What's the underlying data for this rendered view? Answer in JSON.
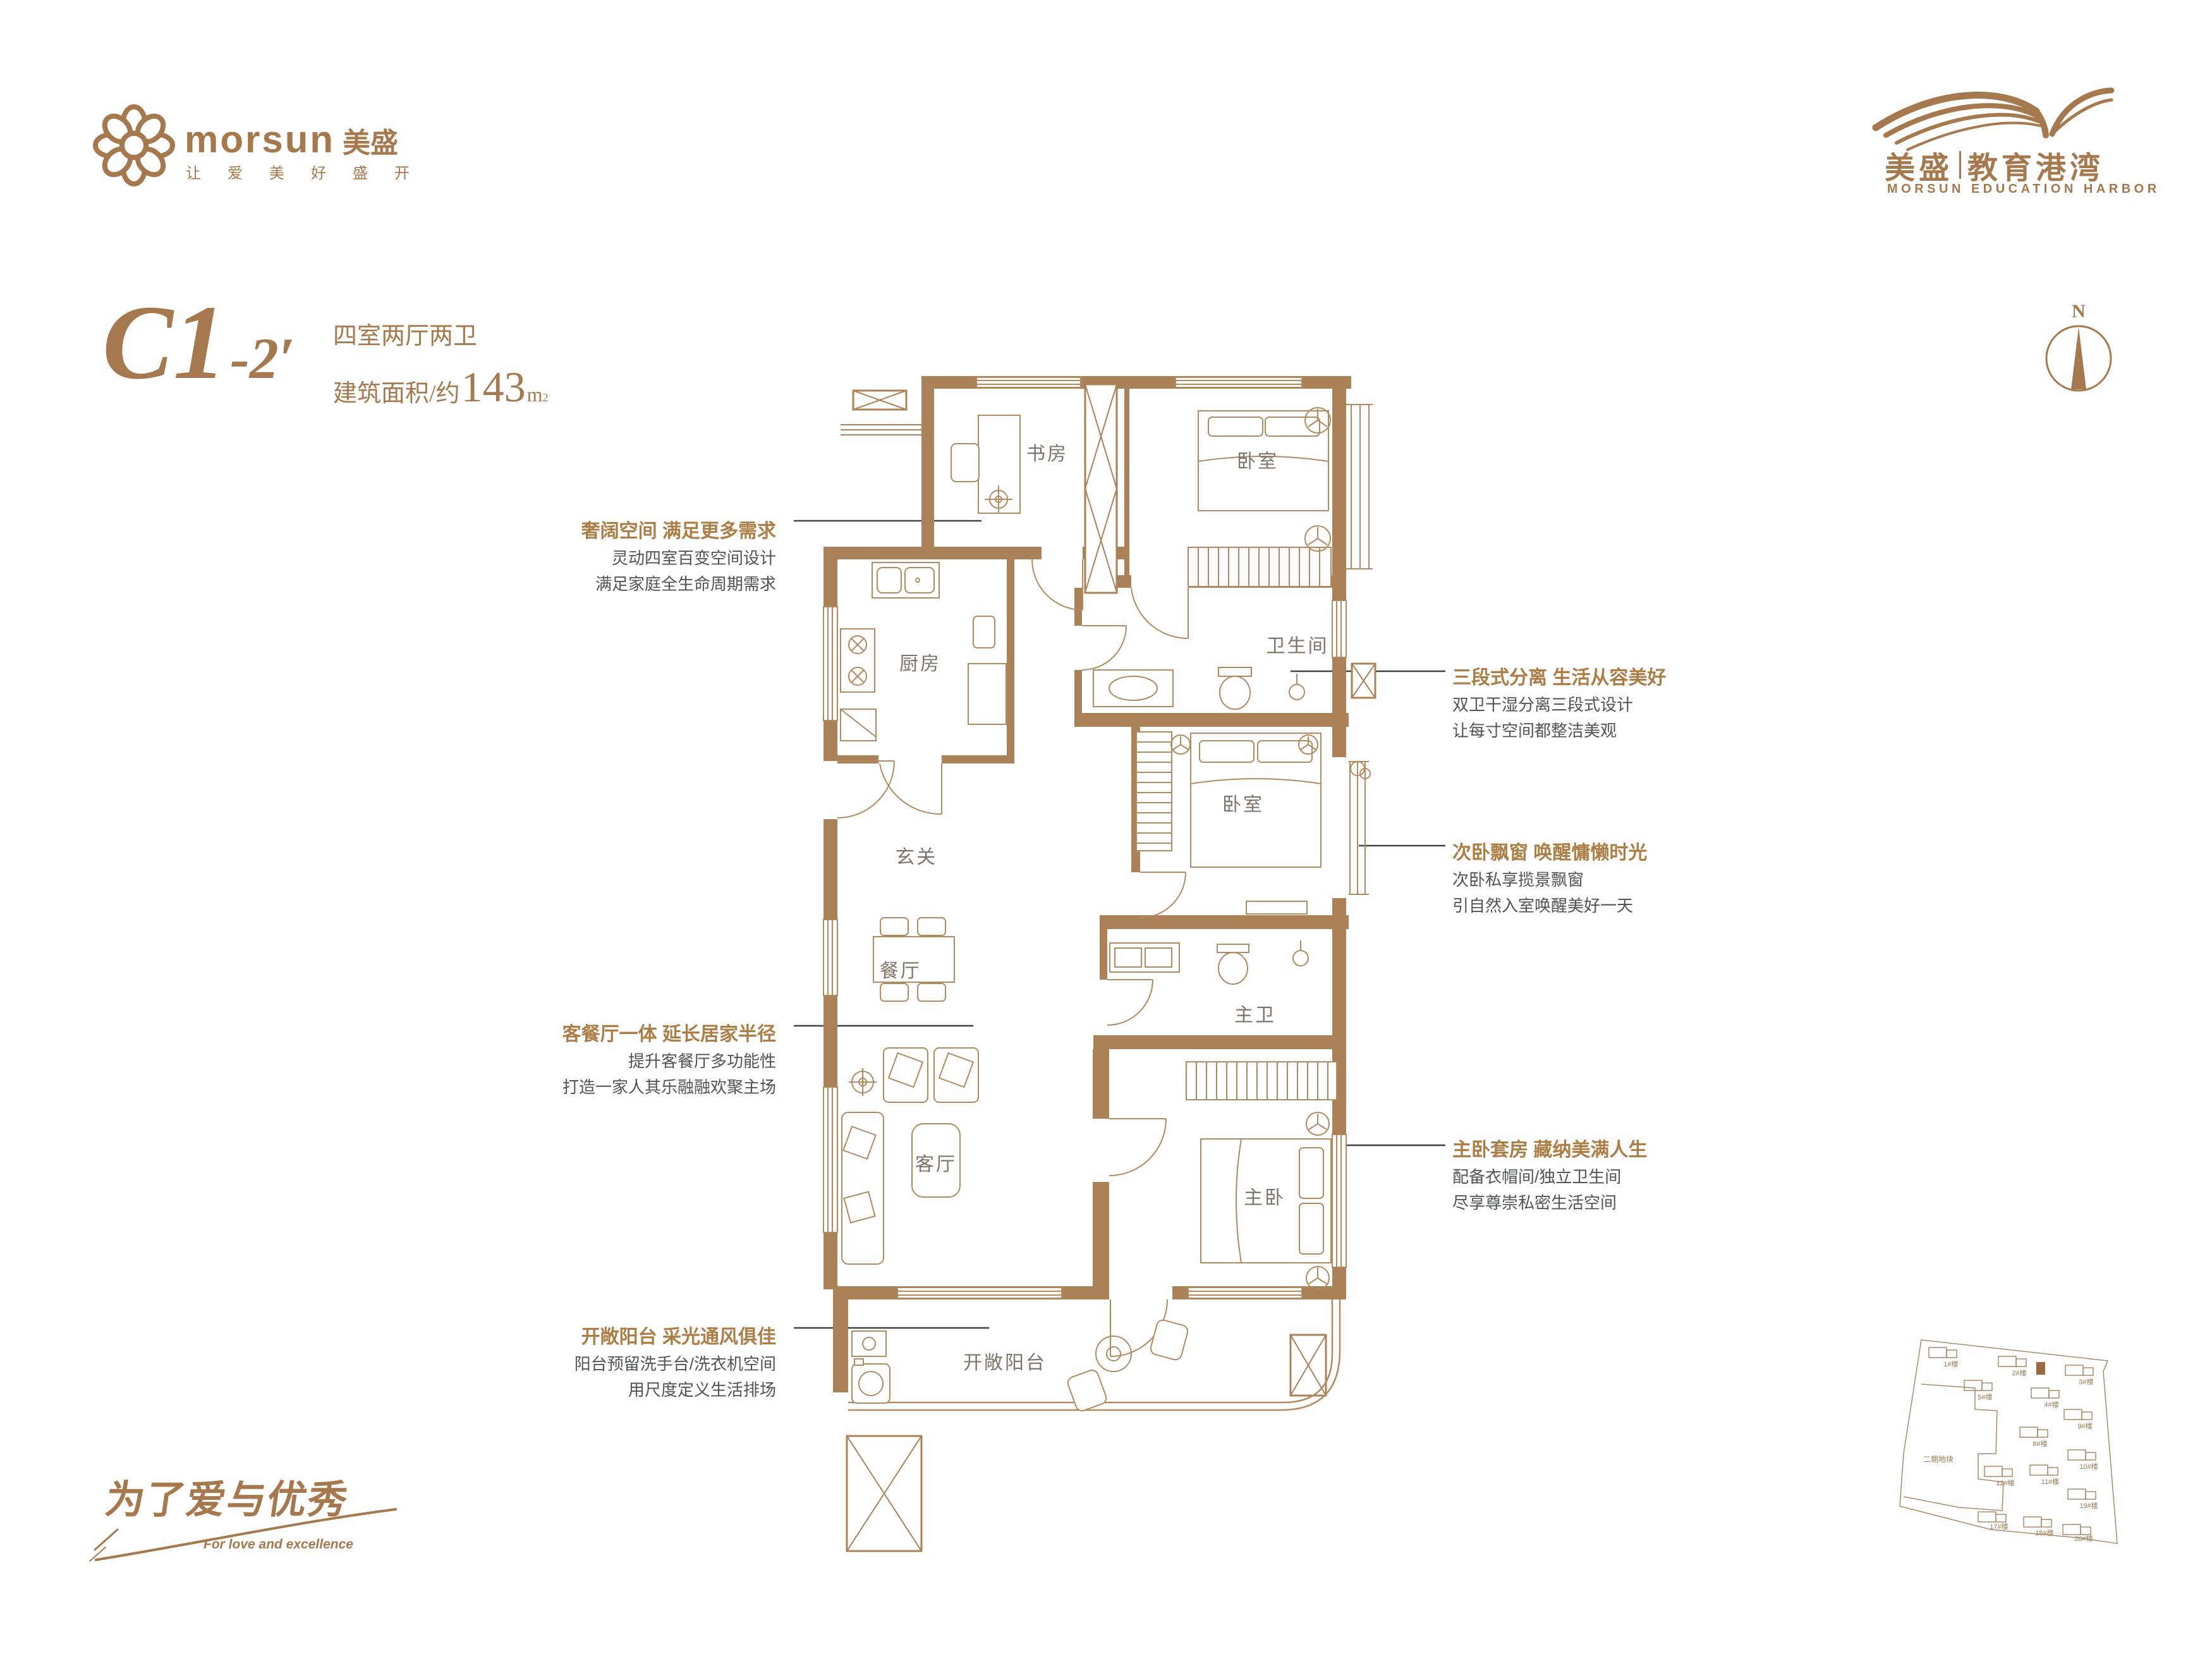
{
  "brand": {
    "logo_en": "morsun",
    "logo_cn": "美盛",
    "tagline": "让爱美好盛开",
    "flower_icon": "flower-icon"
  },
  "project": {
    "cn_left": "美盛",
    "cn_right": "教育港湾",
    "en": "MORSUN EDUCATION HARBOR",
    "wing_icon": "wing-swoosh-icon"
  },
  "unit": {
    "code": "C1",
    "code_suffix": "-2′",
    "spec": "四室两厅两卫",
    "area_prefix": "建筑面积/约",
    "area_value": "143",
    "area_unit": "m",
    "area_sup": "2"
  },
  "compass": {
    "north_label": "N"
  },
  "floorplan": {
    "rooms": [
      {
        "name": "study",
        "label": "书房"
      },
      {
        "name": "bedroom-top",
        "label": "卧室"
      },
      {
        "name": "bathroom",
        "label": "卫生间"
      },
      {
        "name": "kitchen",
        "label": "厨房"
      },
      {
        "name": "foyer",
        "label": "玄关"
      },
      {
        "name": "bedroom-middle",
        "label": "卧室"
      },
      {
        "name": "dining",
        "label": "餐厅"
      },
      {
        "name": "master-bath",
        "label": "主卫"
      },
      {
        "name": "living",
        "label": "客厅"
      },
      {
        "name": "master-bedroom",
        "label": "主卧"
      },
      {
        "name": "balcony",
        "label": "开敞阳台"
      }
    ]
  },
  "annotations": {
    "left": [
      {
        "title": "奢阔空间 满足更多需求",
        "line1": "灵动四室百变空间设计",
        "line2": "满足家庭全生命周期需求"
      },
      {
        "title": "客餐厅一体 延长居家半径",
        "line1": "提升客餐厅多功能性",
        "line2": "打造一家人其乐融融欢聚主场"
      },
      {
        "title": "开敞阳台 采光通风俱佳",
        "line1": "阳台预留洗手台/洗衣机空间",
        "line2": "用尺度定义生活排场"
      }
    ],
    "right": [
      {
        "title": "三段式分离 生活从容美好",
        "line1": "双卫干湿分离三段式设计",
        "line2": "让每寸空间都整洁美观"
      },
      {
        "title": "次卧飘窗 唤醒慵懒时光",
        "line1": "次卧私享揽景飘窗",
        "line2": "引自然入室唤醒美好一天"
      },
      {
        "title": "主卧套房 藏纳美满人生",
        "line1": "配备衣帽间/独立卫生间",
        "line2": "尽享尊崇私密生活空间"
      }
    ]
  },
  "slogan": {
    "cn": "为了爱与优秀",
    "en": "For love and excellence"
  },
  "siteplan": {
    "parcel_label": "二期地块",
    "buildings": [
      {
        "label": "1#楼"
      },
      {
        "label": "2#楼"
      },
      {
        "label": "3#楼"
      },
      {
        "label": "5#楼"
      },
      {
        "label": "4#楼"
      },
      {
        "label": "9#楼"
      },
      {
        "label": "8#楼"
      },
      {
        "label": "10#楼"
      },
      {
        "label": "12#楼"
      },
      {
        "label": "11#楼"
      },
      {
        "label": "19#楼"
      },
      {
        "label": "17#楼"
      },
      {
        "label": "18#楼"
      },
      {
        "label": "20#楼"
      }
    ]
  },
  "colors": {
    "accent_brown": "#a5784d",
    "annotation_title": "#ad7d46",
    "wall_fill": "#ab8158",
    "furniture_stroke": "#b28a5e",
    "room_label": "#7f7467",
    "body_text": "#4e5654",
    "leader_line": "#3c444a",
    "siteplan_stroke": "#a98b69"
  }
}
